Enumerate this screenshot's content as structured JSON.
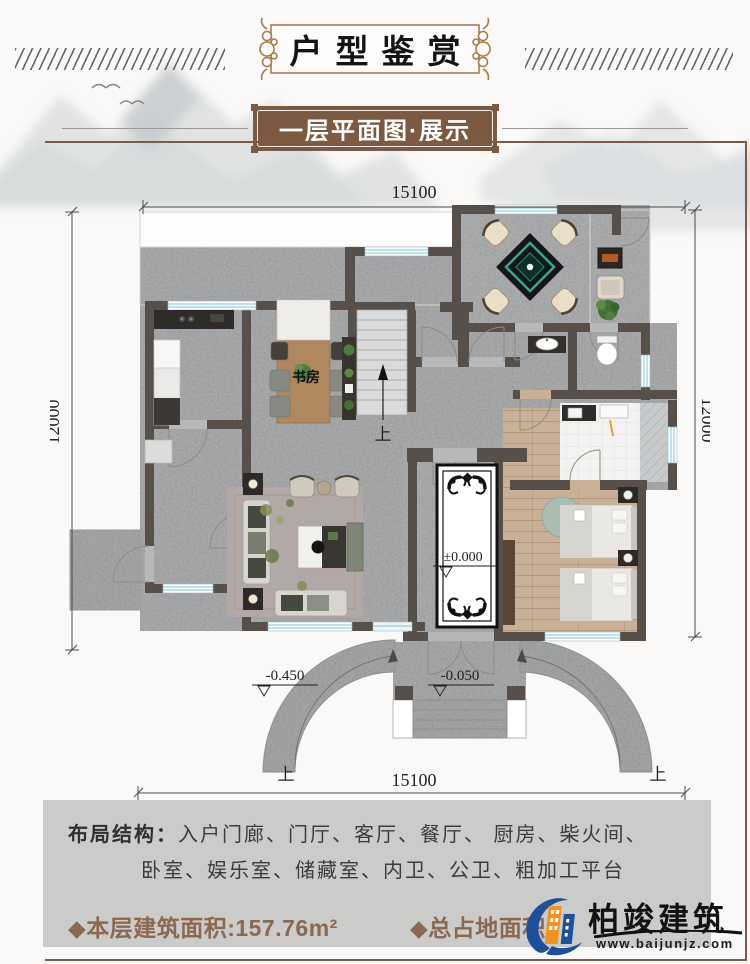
{
  "header": {
    "title": "户型鉴赏",
    "subtitle": "一层平面图·展示"
  },
  "plan": {
    "dim_top": "15100",
    "dim_bottom": "15100",
    "dim_left": "12000",
    "dim_right": "12000",
    "room_study": "书房",
    "level_zero": "±0.000",
    "level_entry": "-0.050",
    "level_ground": "-0.450",
    "up_stairs": "上",
    "up_ramp_left": "上",
    "up_ramp_right": "上"
  },
  "info": {
    "layout_label": "布局结构：",
    "layout_line1": "入户门廊、门厅、客厅、餐厅、 厨房、柴火间、",
    "layout_line2": "卧室、娱乐室、储藏室、内卫、公卫、粗加工平台",
    "floor_area": "◆本层建筑面积:157.76m²",
    "total_area": "◆总占地面积"
  },
  "logo": {
    "name": "柏竣建筑",
    "website": "www.baijunjz.com"
  },
  "colors": {
    "frame_brown": "#7d5b45",
    "plaque_brown": "#7b5a41",
    "ornament_tan": "#a87c4c",
    "area_text_brown": "#8b6950",
    "wall": "#59524b",
    "floor_stone": "#b7b8ba",
    "wood": "#c8b197",
    "window_cyan": "#7fc6d8",
    "dining_table_teal": "#2fae93",
    "panel_gray": "#cbcbca",
    "logo_blue": "#1c4f9c",
    "logo_orange": "#f59120"
  }
}
